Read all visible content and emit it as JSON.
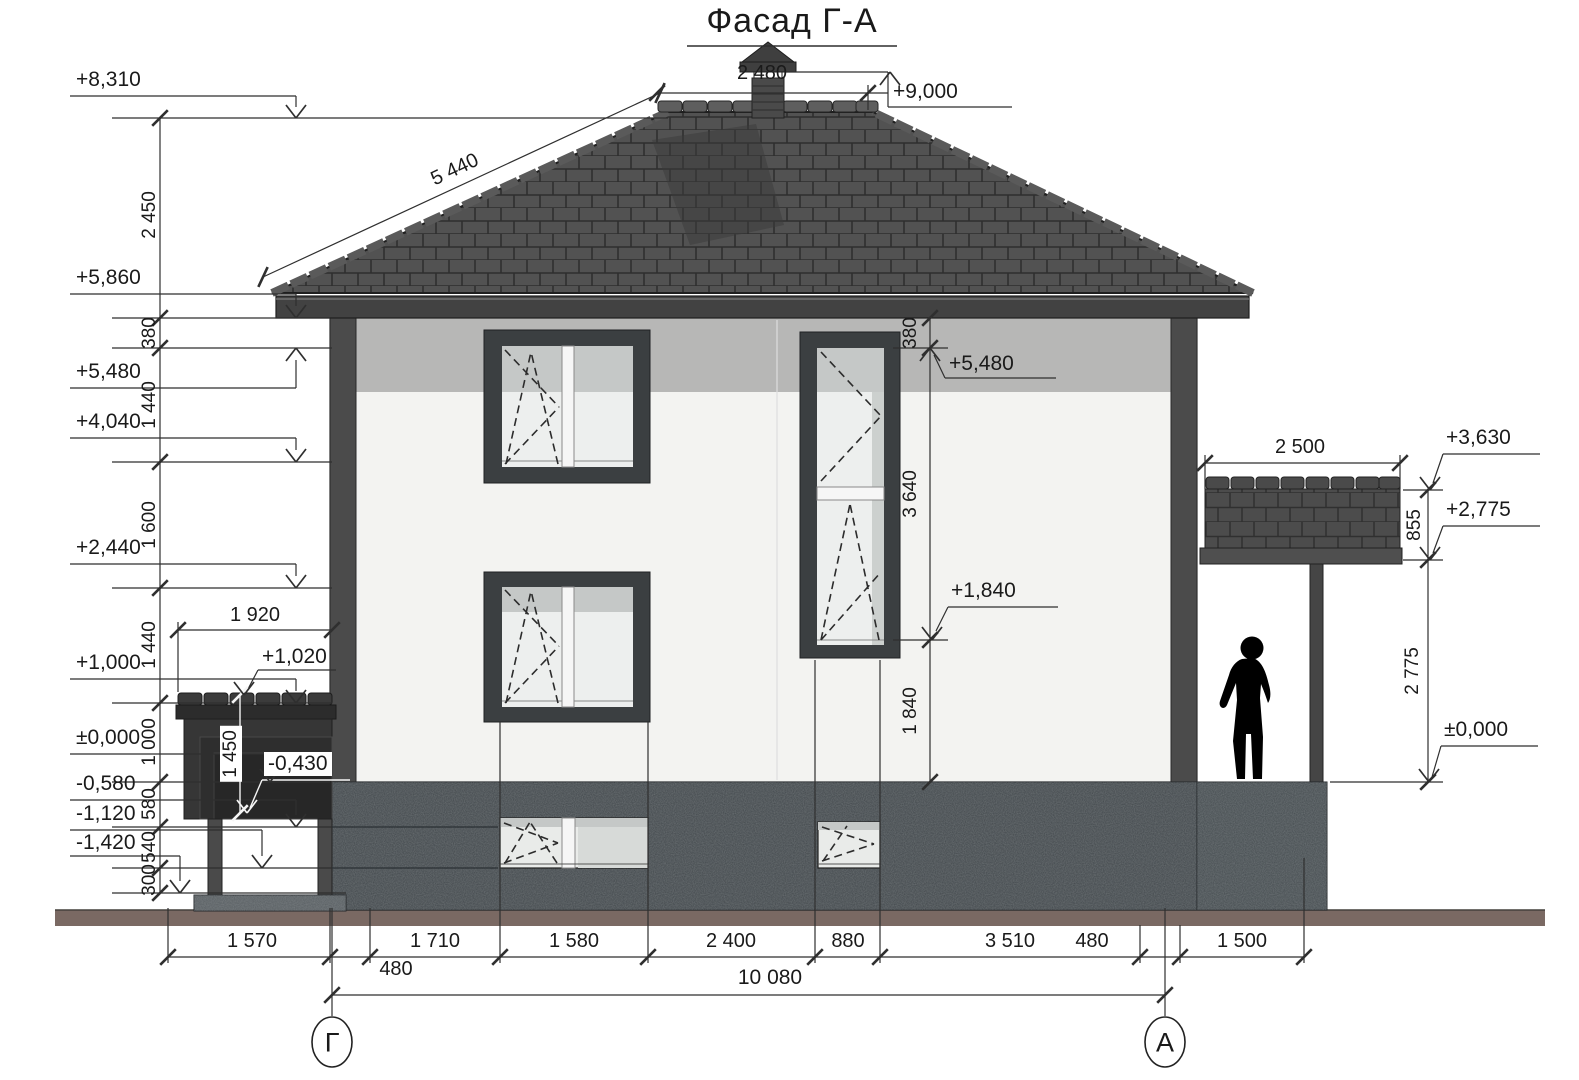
{
  "title": "Фасад Г-А",
  "axis_markers": {
    "left": "Г",
    "right": "А"
  },
  "elevations": {
    "plus8310": "+8,310",
    "plus5860": "+5,860",
    "plus5480_left": "+5,480",
    "plus4040": "+4,040",
    "plus2440": "+2,440",
    "plus1000": "+1,000",
    "zero_left": "±0,000",
    "minus0580": "-0,580",
    "minus1120": "-1,120",
    "minus1420": "-1,420",
    "plus9000": "+9,000",
    "plus5480_mid": "+5,480",
    "plus1840": "+1,840",
    "plus1020": "+1,020",
    "minus0430": "-0,430",
    "plus3630": "+3,630",
    "plus2775": "+2,775",
    "zero_right": "±0,000"
  },
  "dimensions": {
    "left_chain": [
      "2 450",
      "380",
      "1 440",
      "1 600",
      "1 440",
      "1 000",
      "580",
      "540",
      "300"
    ],
    "mid_chain": [
      "380",
      "3 640",
      "1 840"
    ],
    "roof_slope": "5 440",
    "roof_ridge": "2 480",
    "cellar_width": "1 920",
    "cellar_height": "1 450",
    "porch_width": "2 500",
    "porch_chain": [
      "855",
      "2 775"
    ],
    "bottom_chain": [
      "1 570",
      "1 710",
      "1 580",
      "2 400",
      "880",
      "3 510",
      "480",
      "1 500"
    ],
    "bottom_offset": "480",
    "overall_width": "10 080"
  },
  "colors": {
    "paper": "#ffffff",
    "line": "#2f2f2f",
    "roof": "#525252",
    "roof_grid": "#2e2e2e",
    "wall": "#f3f3f1",
    "shade_band": "#b7b7b6",
    "frame": "#3b3f41",
    "glass": "#edefee",
    "glass_shade": "#c5c8c7",
    "basement": "#40464a",
    "ground": "#7a6963",
    "silhouette": "#000000"
  }
}
